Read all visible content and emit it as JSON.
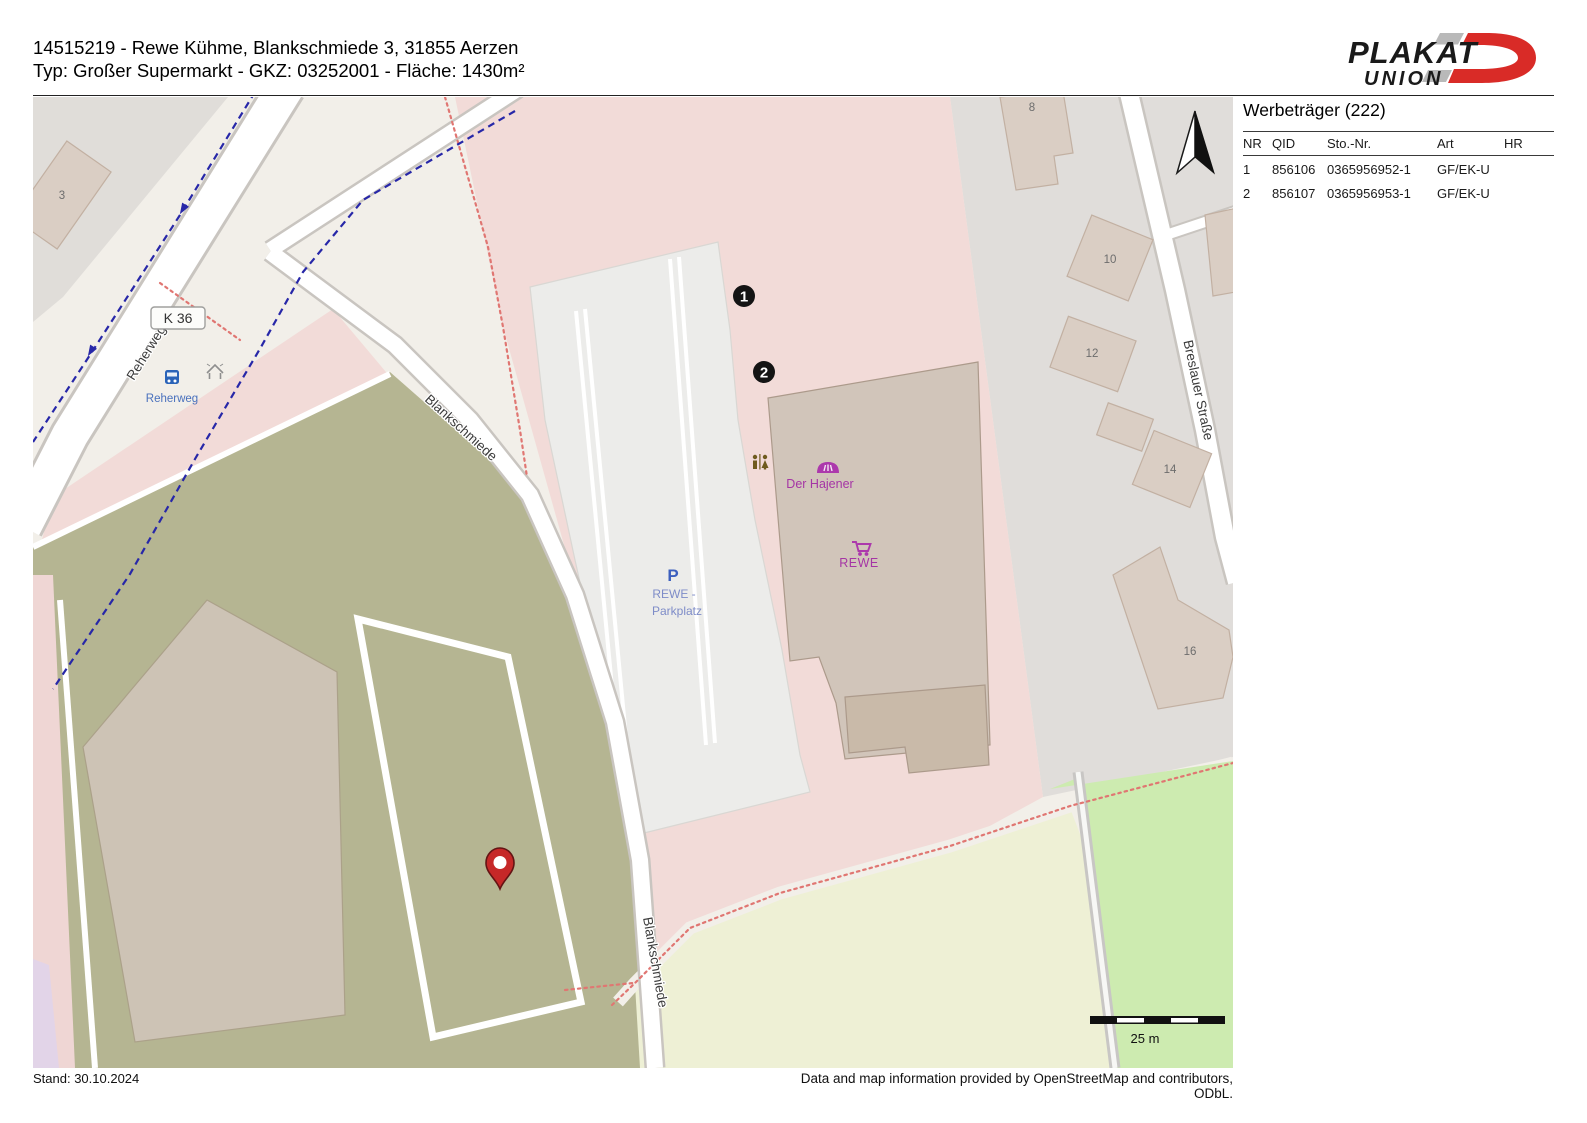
{
  "header": {
    "line1": "14515219 - Rewe Kühme, Blankschmiede 3, 31855 Aerzen",
    "line2": "Typ: Großer Supermarkt - GKZ: 03252001 - Fläche: 1430m²"
  },
  "logo": {
    "word_top": "PLAKAT",
    "word_bottom": "UNION"
  },
  "panel": {
    "title": "Werbeträger (222)",
    "columns": {
      "nr": "NR",
      "qid": "QID",
      "sto": "Sto.-Nr.",
      "art": "Art",
      "hr": "HR"
    },
    "rows": [
      {
        "nr": "1",
        "qid": "856106",
        "sto": "0365956952-1",
        "art": "GF/EK-U",
        "hr": ""
      },
      {
        "nr": "2",
        "qid": "856107",
        "sto": "0365956953-1",
        "art": "GF/EK-U",
        "hr": ""
      }
    ]
  },
  "map": {
    "street_labels": {
      "k36": "K 36",
      "reherweg": "Reherweg",
      "blankschmiede": "Blankschmiede",
      "breslauer": "Breslauer Straße"
    },
    "poi_labels": {
      "bus_stop": "Reherweg",
      "der_hajener": "Der Hajener",
      "rewe": "REWE",
      "parking_p": "P",
      "parking_name_line1": "REWE -",
      "parking_name_line2": "Parkplatz"
    },
    "house_numbers": {
      "h3": "3",
      "h8": "8",
      "h10": "10",
      "h12": "12",
      "h14": "14",
      "h16": "16"
    },
    "markers": [
      {
        "label": "1"
      },
      {
        "label": "2"
      }
    ],
    "scale_label": "25 m"
  },
  "footer": {
    "stand": "Stand: 30.10.2024",
    "attribution": "Data and map information provided by OpenStreetMap and contributors, ODbL."
  },
  "colors": {
    "poi_purple": "#ac39ac",
    "pin_red": "#c62828",
    "route_blue": "#2727a8",
    "path_red": "#e07672",
    "logo_red": "#d92b27"
  }
}
